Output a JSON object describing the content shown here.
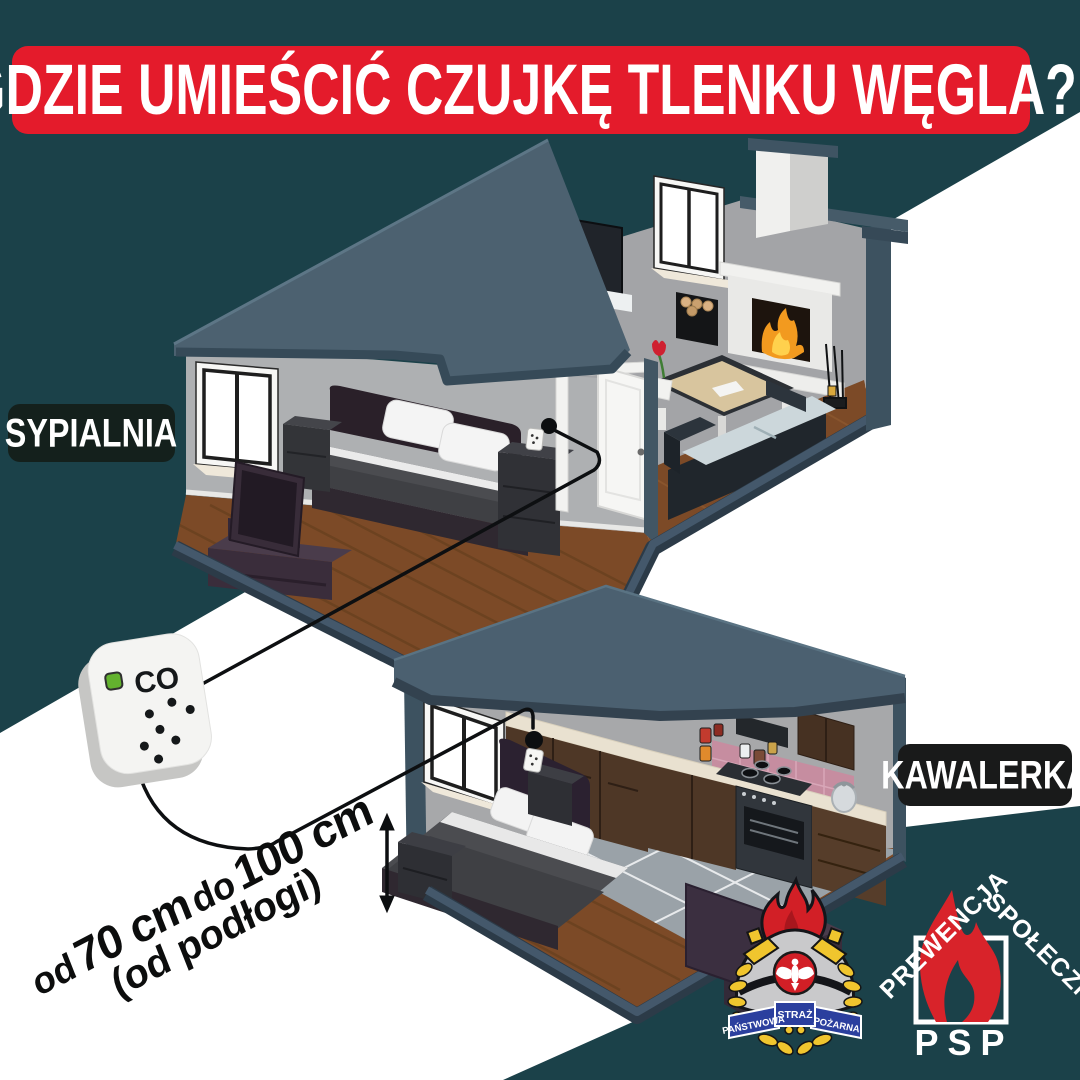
{
  "title": {
    "text": "GDZIE UMIEŚCIĆ CZUJKĘ TLENKU WĘGLA?"
  },
  "labels": {
    "bedroom": "SYPIALNIA",
    "studio": "KAWALERKA"
  },
  "detector": {
    "display_text": "CO"
  },
  "dimension": {
    "prefix": "od",
    "value1": "70 cm",
    "mid": "do",
    "value2": "100 cm",
    "line2": "(od podłogi)"
  },
  "logos": {
    "psp_badge": {
      "ribbon": [
        "PAŃSTWOWA",
        "STRAŻ",
        "POŻARNA"
      ]
    },
    "prewencja": {
      "left_text": "PREWENCJA",
      "right_text": "SPOŁECZNA",
      "bottom_text": "PSP"
    }
  },
  "palette": {
    "background_teal": "#1b4149",
    "banner_red": "#e41b2b",
    "roof_slate": "#4c6170",
    "slab_navy": "#2c3b48",
    "wall_gray": "#a8a9ab",
    "floor_wood": "#7c4a27",
    "led_green": "#63b22e",
    "flame_red": "#d8232a",
    "badge_gold": "#f0c52e",
    "ribbon_blue": "#2b3f9e",
    "white": "#ffffff"
  }
}
